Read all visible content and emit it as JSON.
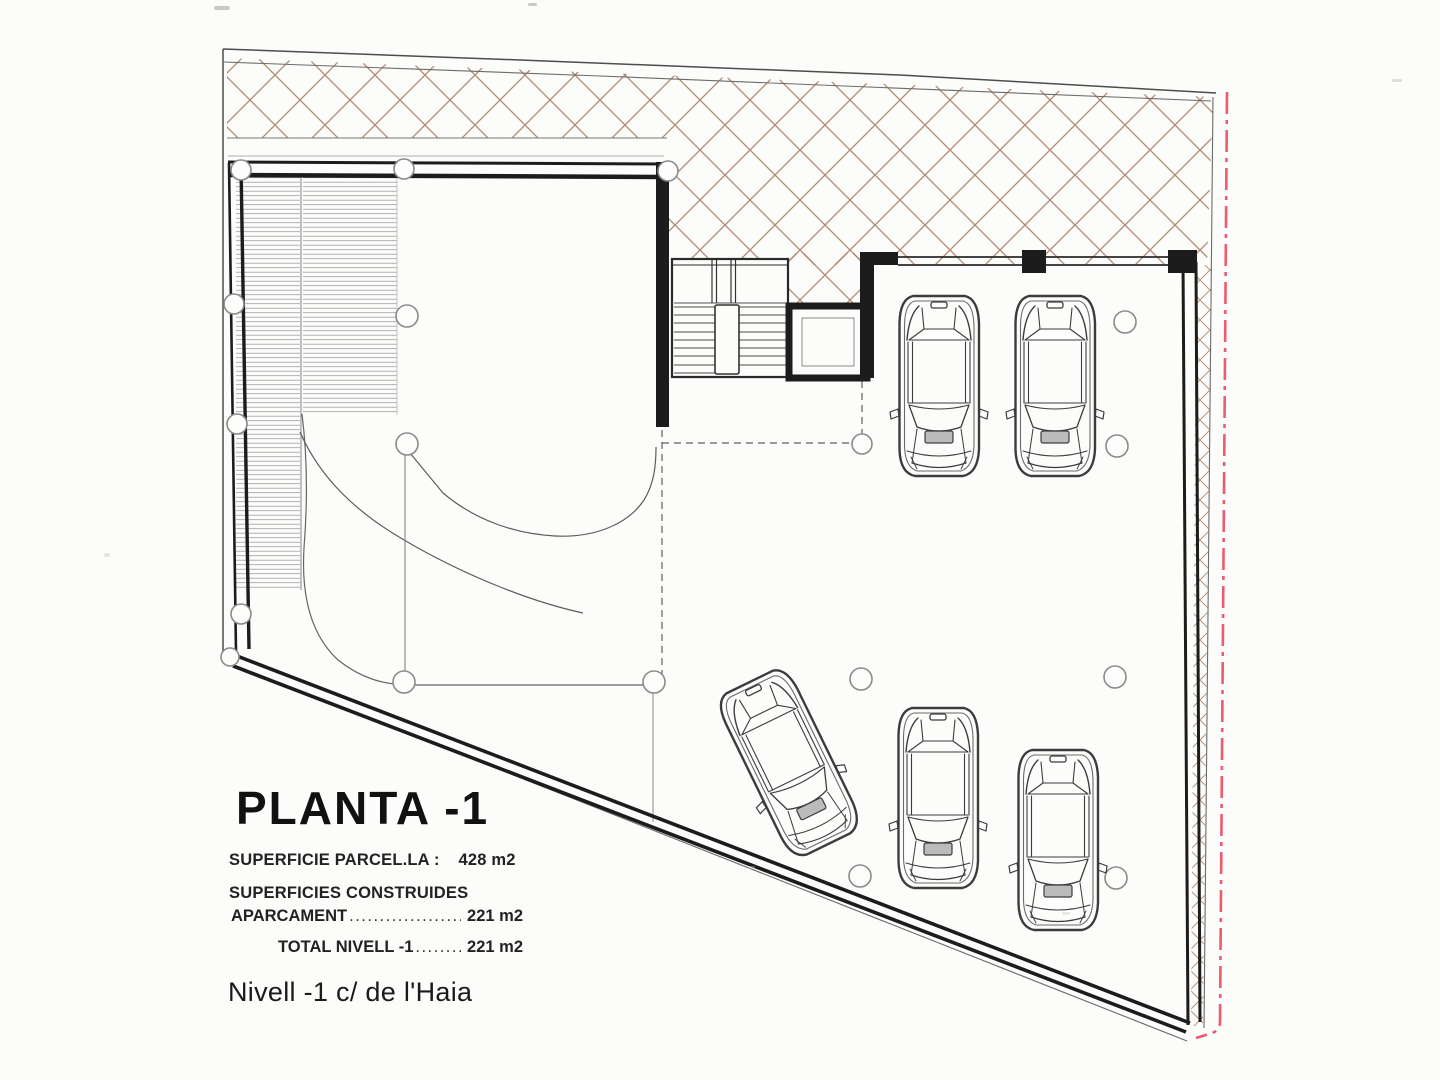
{
  "document": {
    "kind": "architectural-floor-plan"
  },
  "colors": {
    "paper": "#fcfcfb",
    "wall_ink": "#1c1c1c",
    "hatch_brown": "#a87a60",
    "ramp_hatch_gray": "#9e9e9e",
    "boundary_red": "#ee5b6e",
    "thin_line_gray": "#555555"
  },
  "plan": {
    "car_count": 5
  },
  "title_block": {
    "title": "PLANTA -1",
    "site_area_label": "SUPERFICIE PARCEL.LA :",
    "site_area_value": "428 m2",
    "built_header": "SUPERFICIES CONSTRUIDES",
    "rows": [
      {
        "label": "APARCAMENT",
        "dots": "..........................................",
        "value": "221 m2"
      },
      {
        "label": "TOTAL NIVELL -1",
        "dots": "......................",
        "value": "221 m2"
      }
    ],
    "level_caption": "Nivell -1 c/ de l'Haia"
  }
}
